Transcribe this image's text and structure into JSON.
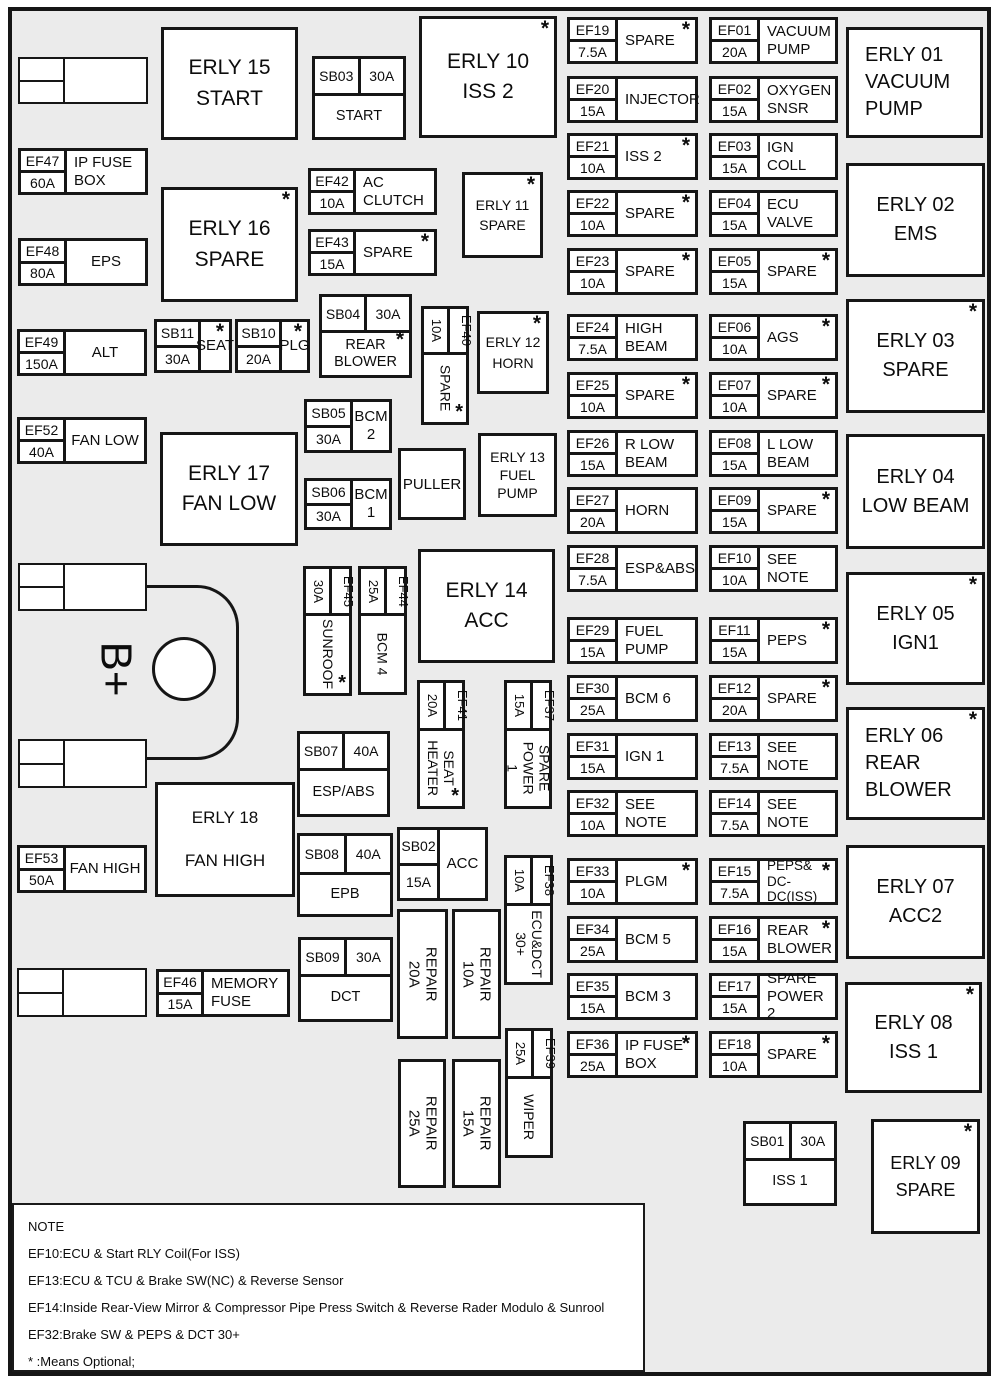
{
  "colors": {
    "board_bg": "#ebebeb",
    "box_bg": "#ffffff",
    "line": "#161616",
    "page_bg": "#ffffff"
  },
  "note": {
    "title": "NOTE",
    "lines": [
      "EF10:ECU & Start RLY Coil(For ISS)",
      "EF13:ECU & TCU & Brake SW(NC) & Reverse Sensor",
      "EF14:Inside Rear-View Mirror & Compressor Pipe Press Switch & Reverse Rader Modulo & Sunrool",
      "EF32:Brake SW & PEPS & DCT 30+",
      "* :Means Optional;"
    ]
  },
  "battery": {
    "label": "B+",
    "text_box": [
      92,
      640,
      48,
      58
    ],
    "circle": [
      152,
      637,
      64,
      64
    ],
    "curve": [
      147,
      585,
      92,
      175
    ]
  },
  "puller": {
    "label": "PULLER",
    "box": [
      398,
      448,
      68,
      72
    ]
  },
  "connectors": [
    [
      18,
      57,
      130,
      47
    ],
    [
      18,
      563,
      129,
      48
    ],
    [
      18,
      739,
      129,
      49
    ],
    [
      17,
      968,
      130,
      49
    ]
  ],
  "relays": [
    {
      "id": "ERLY 15",
      "lines": "ERLY 15\nSTART",
      "box": [
        161,
        27,
        137,
        113
      ],
      "fs": 21,
      "ast": false,
      "align": "center"
    },
    {
      "id": "ERLY 16",
      "lines": "ERLY 16\nSPARE",
      "box": [
        161,
        187,
        137,
        115
      ],
      "fs": 21,
      "ast": true,
      "align": "center"
    },
    {
      "id": "ERLY 17",
      "lines": "ERLY 17\nFAN LOW",
      "box": [
        160,
        432,
        138,
        114
      ],
      "fs": 21,
      "ast": false,
      "align": "center"
    },
    {
      "id": "ERLY 18",
      "lines": "ERLY 18\nFAN HIGH",
      "box": [
        155,
        782,
        140,
        115
      ],
      "fs": 17,
      "ast": false,
      "align": "center",
      "lh": 2.5
    },
    {
      "id": "ERLY 10",
      "lines": "ERLY 10\nISS 2",
      "box": [
        419,
        16,
        138,
        122
      ],
      "fs": 21,
      "ast": true,
      "align": "center"
    },
    {
      "id": "ERLY 11",
      "lines": "ERLY 11\nSPARE",
      "box": [
        462,
        172,
        81,
        86
      ],
      "fs": 14,
      "ast": true,
      "align": "center"
    },
    {
      "id": "ERLY 12",
      "lines": "ERLY 12\nHORN",
      "box": [
        477,
        311,
        72,
        83
      ],
      "fs": 14,
      "ast": true,
      "align": "center"
    },
    {
      "id": "ERLY 13",
      "lines": "ERLY 13\nFUEL\nPUMP",
      "box": [
        478,
        433,
        79,
        84
      ],
      "fs": 14,
      "ast": false,
      "align": "center",
      "lh": 1.3
    },
    {
      "id": "ERLY 14",
      "lines": "ERLY 14\nACC",
      "box": [
        418,
        549,
        137,
        114
      ],
      "fs": 21,
      "ast": false,
      "align": "center"
    },
    {
      "id": "ERLY 01",
      "lines": "ERLY 01\nVACUUM\nPUMP",
      "box": [
        846,
        27,
        137,
        111
      ],
      "fs": 20,
      "ast": false,
      "align": "left",
      "lh": 1.35
    },
    {
      "id": "ERLY 02",
      "lines": "ERLY 02\nEMS",
      "box": [
        846,
        163,
        139,
        114
      ],
      "fs": 20,
      "ast": false,
      "align": "center"
    },
    {
      "id": "ERLY 03",
      "lines": "ERLY 03\nSPARE",
      "box": [
        846,
        299,
        139,
        114
      ],
      "fs": 20,
      "ast": true,
      "align": "center"
    },
    {
      "id": "ERLY 04",
      "lines": "ERLY 04\nLOW BEAM",
      "box": [
        846,
        434,
        139,
        115
      ],
      "fs": 20,
      "ast": false,
      "align": "center"
    },
    {
      "id": "ERLY 05",
      "lines": "ERLY 05\nIGN1",
      "box": [
        846,
        572,
        139,
        113
      ],
      "fs": 20,
      "ast": true,
      "align": "center"
    },
    {
      "id": "ERLY 06",
      "lines": "ERLY 06\nREAR\nBLOWER",
      "box": [
        846,
        707,
        139,
        113
      ],
      "fs": 20,
      "ast": true,
      "align": "left",
      "lh": 1.35
    },
    {
      "id": "ERLY 07",
      "lines": "ERLY 07\nACC2",
      "box": [
        846,
        845,
        139,
        114
      ],
      "fs": 20,
      "ast": false,
      "align": "center"
    },
    {
      "id": "ERLY 08",
      "lines": "ERLY 08\nISS 1",
      "box": [
        845,
        982,
        137,
        111
      ],
      "fs": 20,
      "ast": true,
      "align": "center"
    },
    {
      "id": "ERLY 09",
      "lines": "ERLY 09\nSPARE",
      "box": [
        871,
        1119,
        109,
        115
      ],
      "fs": 18,
      "ast": true,
      "align": "center"
    }
  ],
  "fuses": [
    {
      "code": "EF19",
      "amp": "7.5A",
      "label": "SPARE",
      "box": [
        567,
        17,
        131,
        47
      ],
      "ast": true
    },
    {
      "code": "EF20",
      "amp": "15A",
      "label": "INJECTOR",
      "box": [
        567,
        76,
        131,
        47
      ],
      "ast": false
    },
    {
      "code": "EF21",
      "amp": "10A",
      "label": "ISS 2",
      "box": [
        567,
        133,
        131,
        47
      ],
      "ast": true
    },
    {
      "code": "EF22",
      "amp": "10A",
      "label": "SPARE",
      "box": [
        567,
        190,
        131,
        47
      ],
      "ast": true
    },
    {
      "code": "EF23",
      "amp": "10A",
      "label": "SPARE",
      "box": [
        567,
        248,
        131,
        47
      ],
      "ast": true
    },
    {
      "code": "EF24",
      "amp": "7.5A",
      "label": "HIGH\nBEAM",
      "box": [
        567,
        314,
        131,
        47
      ],
      "ast": false
    },
    {
      "code": "EF25",
      "amp": "10A",
      "label": "SPARE",
      "box": [
        567,
        372,
        131,
        47
      ],
      "ast": true
    },
    {
      "code": "EF26",
      "amp": "15A",
      "label": "R LOW\nBEAM",
      "box": [
        567,
        430,
        131,
        47
      ],
      "ast": false
    },
    {
      "code": "EF27",
      "amp": "20A",
      "label": "HORN",
      "box": [
        567,
        487,
        131,
        47
      ],
      "ast": false
    },
    {
      "code": "EF28",
      "amp": "7.5A",
      "label": "ESP&ABS",
      "box": [
        567,
        545,
        131,
        47
      ],
      "ast": false
    },
    {
      "code": "EF29",
      "amp": "15A",
      "label": "FUEL\nPUMP",
      "box": [
        567,
        617,
        131,
        47
      ],
      "ast": false
    },
    {
      "code": "EF30",
      "amp": "25A",
      "label": "BCM 6",
      "box": [
        567,
        675,
        131,
        47
      ],
      "ast": false
    },
    {
      "code": "EF31",
      "amp": "15A",
      "label": "IGN 1",
      "box": [
        567,
        733,
        131,
        47
      ],
      "ast": false
    },
    {
      "code": "EF32",
      "amp": "10A",
      "label": "SEE NOTE",
      "box": [
        567,
        790,
        131,
        47
      ],
      "ast": false
    },
    {
      "code": "EF33",
      "amp": "10A",
      "label": "PLGM",
      "box": [
        567,
        858,
        131,
        47
      ],
      "ast": true
    },
    {
      "code": "EF34",
      "amp": "25A",
      "label": "BCM 5",
      "box": [
        567,
        916,
        131,
        47
      ],
      "ast": false
    },
    {
      "code": "EF35",
      "amp": "15A",
      "label": "BCM 3",
      "box": [
        567,
        973,
        131,
        47
      ],
      "ast": false
    },
    {
      "code": "EF36",
      "amp": "25A",
      "label": "IP FUSE\nBOX",
      "box": [
        567,
        1031,
        131,
        47
      ],
      "ast": true
    },
    {
      "code": "EF01",
      "amp": "20A",
      "label": "VACUUM\nPUMP",
      "box": [
        709,
        17,
        129,
        47
      ],
      "ast": false
    },
    {
      "code": "EF02",
      "amp": "15A",
      "label": "OXYGEN\nSNSR",
      "box": [
        709,
        76,
        129,
        47
      ],
      "ast": false
    },
    {
      "code": "EF03",
      "amp": "15A",
      "label": "IGN COLL",
      "box": [
        709,
        133,
        129,
        47
      ],
      "ast": false
    },
    {
      "code": "EF04",
      "amp": "15A",
      "label": "ECU VALVE",
      "box": [
        709,
        190,
        129,
        47
      ],
      "ast": false
    },
    {
      "code": "EF05",
      "amp": "15A",
      "label": "SPARE",
      "box": [
        709,
        248,
        129,
        47
      ],
      "ast": true
    },
    {
      "code": "EF06",
      "amp": "10A",
      "label": "AGS",
      "box": [
        709,
        314,
        129,
        47
      ],
      "ast": true
    },
    {
      "code": "EF07",
      "amp": "10A",
      "label": "SPARE",
      "box": [
        709,
        372,
        129,
        47
      ],
      "ast": true
    },
    {
      "code": "EF08",
      "amp": "15A",
      "label": "L LOW\nBEAM",
      "box": [
        709,
        430,
        129,
        47
      ],
      "ast": false
    },
    {
      "code": "EF09",
      "amp": "15A",
      "label": "SPARE",
      "box": [
        709,
        487,
        129,
        47
      ],
      "ast": true
    },
    {
      "code": "EF10",
      "amp": "10A",
      "label": "SEE NOTE",
      "box": [
        709,
        545,
        129,
        47
      ],
      "ast": false
    },
    {
      "code": "EF11",
      "amp": "15A",
      "label": "PEPS",
      "box": [
        709,
        617,
        129,
        47
      ],
      "ast": true
    },
    {
      "code": "EF12",
      "amp": "20A",
      "label": "SPARE",
      "box": [
        709,
        675,
        129,
        47
      ],
      "ast": true
    },
    {
      "code": "EF13",
      "amp": "7.5A",
      "label": "SEE NOTE",
      "box": [
        709,
        733,
        129,
        47
      ],
      "ast": false
    },
    {
      "code": "EF14",
      "amp": "7.5A",
      "label": "SEE NOTE",
      "box": [
        709,
        790,
        129,
        47
      ],
      "ast": false
    },
    {
      "code": "EF15",
      "amp": "7.5A",
      "label": "PEPS&\nDC-DC(ISS)",
      "box": [
        709,
        858,
        129,
        47
      ],
      "ast": true,
      "fs": 13.5
    },
    {
      "code": "EF16",
      "amp": "15A",
      "label": "REAR\nBLOWER",
      "box": [
        709,
        916,
        129,
        47
      ],
      "ast": true
    },
    {
      "code": "EF17",
      "amp": "15A",
      "label": "SPARE\nPOWER 2",
      "box": [
        709,
        973,
        129,
        47
      ],
      "ast": false
    },
    {
      "code": "EF18",
      "amp": "10A",
      "label": "SPARE",
      "box": [
        709,
        1031,
        129,
        47
      ],
      "ast": true
    },
    {
      "code": "EF47",
      "amp": "60A",
      "label": "IP FUSE\nBOX",
      "box": [
        18,
        148,
        130,
        47
      ],
      "ast": false,
      "lw": 46
    },
    {
      "code": "EF48",
      "amp": "80A",
      "label": "EPS",
      "box": [
        18,
        238,
        130,
        48
      ],
      "ast": false,
      "lw": 46,
      "align": "center"
    },
    {
      "code": "EF49",
      "amp": "150A",
      "label": "ALT",
      "box": [
        17,
        329,
        130,
        47
      ],
      "ast": false,
      "lw": 46,
      "align": "center"
    },
    {
      "code": "EF52",
      "amp": "40A",
      "label": "FAN LOW",
      "box": [
        17,
        417,
        130,
        47
      ],
      "ast": false,
      "lw": 46,
      "align": "center"
    },
    {
      "code": "EF53",
      "amp": "50A",
      "label": "FAN HIGH",
      "box": [
        17,
        845,
        130,
        48
      ],
      "ast": false,
      "lw": 46,
      "align": "center"
    },
    {
      "code": "EF46",
      "amp": "15A",
      "label": "MEMORY\nFUSE",
      "box": [
        156,
        969,
        134,
        48
      ],
      "ast": false,
      "lw": 45
    },
    {
      "code": "EF42",
      "amp": "10A",
      "label": "AC CLUTCH",
      "box": [
        308,
        168,
        129,
        47
      ],
      "ast": false,
      "lw": 45
    },
    {
      "code": "EF43",
      "amp": "15A",
      "label": "SPARE",
      "box": [
        308,
        229,
        129,
        47
      ],
      "ast": true,
      "lw": 45
    }
  ],
  "sb_cols": [
    {
      "code": "SB11",
      "amp": "30A",
      "label": "SEAT",
      "box": [
        154,
        319,
        78,
        54
      ],
      "ast": true,
      "lw": 44,
      "align": "center"
    },
    {
      "code": "SB10",
      "amp": "20A",
      "label": "PLG",
      "box": [
        235,
        319,
        75,
        54
      ],
      "ast": true,
      "lw": 44,
      "align": "center"
    },
    {
      "code": "SB05",
      "amp": "30A",
      "label": "BCM 2",
      "box": [
        304,
        399,
        88,
        54
      ],
      "ast": false,
      "lw": 46,
      "align": "center"
    },
    {
      "code": "SB06",
      "amp": "30A",
      "label": "BCM 1",
      "box": [
        304,
        478,
        88,
        52
      ],
      "ast": false,
      "lw": 46,
      "align": "center"
    },
    {
      "code": "SB02",
      "amp": "15A",
      "label": "ACC",
      "box": [
        397,
        827,
        91,
        74
      ],
      "ast": false,
      "lw": 40,
      "align": "center"
    }
  ],
  "sb_rows": [
    {
      "code": "SB03",
      "amp": "30A",
      "label": "START",
      "box": [
        312,
        56,
        94,
        84
      ],
      "hh": 37,
      "ast": false
    },
    {
      "code": "SB04",
      "amp": "30A",
      "label": "REAR\nBLOWER",
      "box": [
        319,
        294,
        93,
        84
      ],
      "hh": 36,
      "ast": true
    },
    {
      "code": "SB07",
      "amp": "40A",
      "label": "ESP/ABS",
      "box": [
        297,
        731,
        93,
        86
      ],
      "hh": 37,
      "ast": false
    },
    {
      "code": "SB08",
      "amp": "40A",
      "label": "EPB",
      "box": [
        297,
        833,
        96,
        84
      ],
      "hh": 39,
      "ast": false
    },
    {
      "code": "SB09",
      "amp": "30A",
      "label": "DCT",
      "box": [
        298,
        937,
        95,
        85
      ],
      "hh": 37,
      "ast": false
    },
    {
      "code": "SB01",
      "amp": "30A",
      "label": "ISS 1",
      "box": [
        743,
        1121,
        94,
        85
      ],
      "hh": 37,
      "ast": false
    }
  ],
  "fuses_v": [
    {
      "code": "EF40",
      "amp": "10A",
      "label": "SPARE",
      "box": [
        421,
        306,
        48,
        119
      ],
      "hh": 46,
      "ast": true
    },
    {
      "code": "EF45",
      "amp": "30A",
      "label": "SUNROOF",
      "box": [
        303,
        566,
        49,
        130
      ],
      "hh": 47,
      "ast": true
    },
    {
      "code": "EF44",
      "amp": "25A",
      "label": "BCM 4",
      "box": [
        358,
        566,
        49,
        129
      ],
      "hh": 47,
      "ast": false
    },
    {
      "code": "EF41",
      "amp": "20A",
      "label": "SEAT\nHEATER",
      "box": [
        417,
        680,
        48,
        129
      ],
      "hh": 48,
      "ast": true
    },
    {
      "code": "EF37",
      "amp": "15A",
      "label": "SPARE\nPOWER 1",
      "box": [
        504,
        680,
        48,
        129
      ],
      "hh": 48,
      "ast": false
    },
    {
      "code": "EF38",
      "amp": "10A",
      "label": "ECU&DCT\n30+",
      "box": [
        504,
        855,
        49,
        130
      ],
      "hh": 48,
      "ast": false
    },
    {
      "code": "EF39",
      "amp": "25A",
      "label": "WIPER",
      "box": [
        505,
        1028,
        48,
        130
      ],
      "hh": 48,
      "ast": false
    }
  ],
  "repairs": [
    {
      "label": "REPAIR 20A",
      "box": [
        397,
        909,
        51,
        130
      ]
    },
    {
      "label": "REPAIR 10A",
      "box": [
        452,
        909,
        49,
        130
      ]
    },
    {
      "label": "REPAIR 25A",
      "box": [
        398,
        1059,
        48,
        129
      ]
    },
    {
      "label": "REPAIR 15A",
      "box": [
        452,
        1059,
        49,
        129
      ]
    }
  ]
}
